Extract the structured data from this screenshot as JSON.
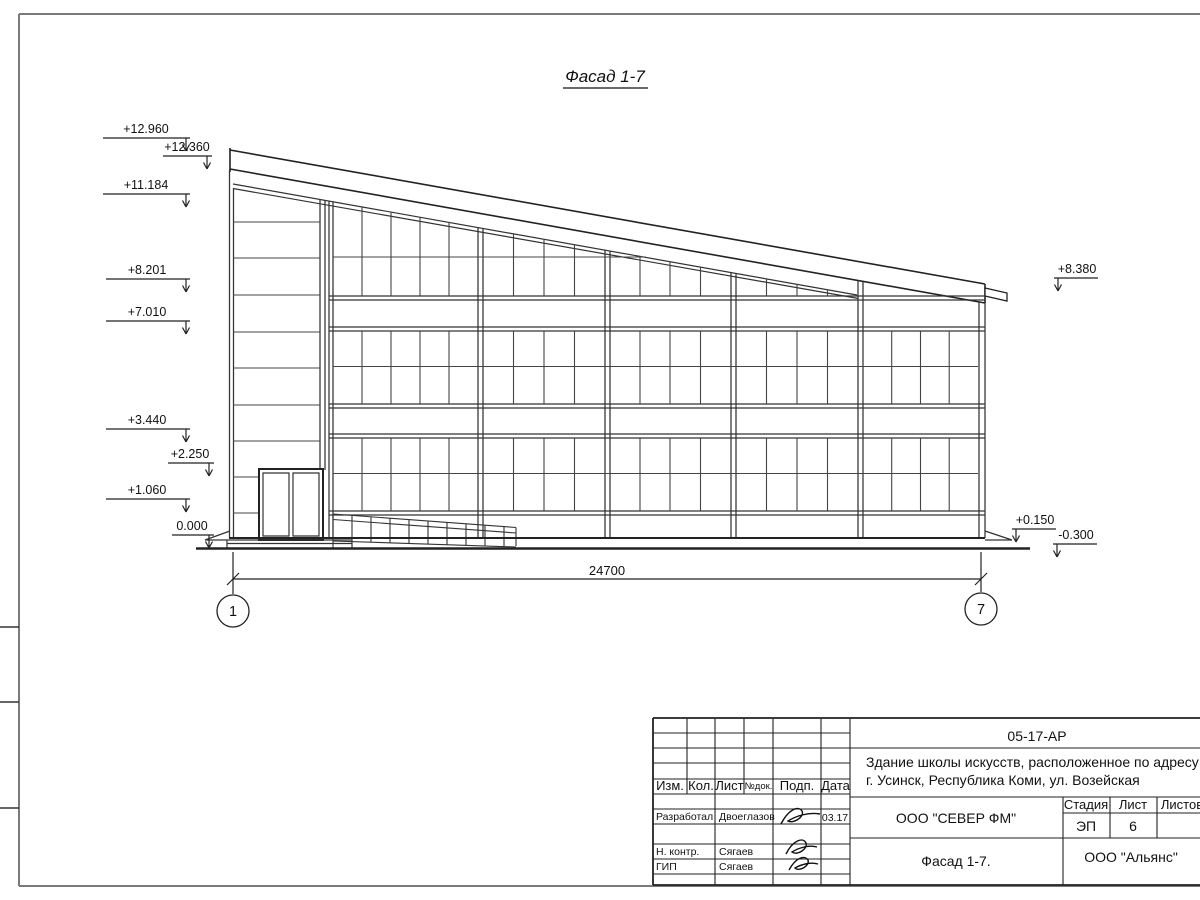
{
  "sheet": {
    "title": "Фасад 1-7",
    "dimension_total": "24700",
    "grid_axis_left": "1",
    "grid_axis_right": "7",
    "elevations_left": [
      {
        "value": "+12.960"
      },
      {
        "value": "+12.360"
      },
      {
        "value": "+11.184"
      },
      {
        "value": "+8.201"
      },
      {
        "value": "+7.010"
      },
      {
        "value": "+3.440"
      },
      {
        "value": "+2.250"
      },
      {
        "value": "+1.060"
      },
      {
        "value": "0.000"
      }
    ],
    "elevations_right": [
      {
        "value": "+8.380"
      },
      {
        "value": "+0.150"
      },
      {
        "value": "-0.300"
      }
    ]
  },
  "title_block": {
    "doc_number": "05-17-АР",
    "project_line1": "Здание школы искусств, расположенное по адресу:",
    "project_line2": "г. Усинск, Республика Коми, ул. Возейская",
    "company": "ООО \"СЕВЕР ФМ\"",
    "drawing_name": "Фасад 1-7.",
    "client": "ООО \"Альянс\"",
    "stage_label": "Стадия",
    "stage_value": "ЭП",
    "sheet_label": "Лист",
    "sheet_value": "6",
    "sheets_label": "Листов",
    "col_izm": "Изм.",
    "col_kol": "Кол.",
    "col_list": "Лист",
    "col_dok": "№док.",
    "col_podp": "Подп.",
    "col_data": "Дата",
    "row1_role": "Разработал",
    "row1_name": "Двоеглазов",
    "row1_date": "03.17",
    "row2_role": "Н. контр.",
    "row2_name": "Сягаев",
    "row3_role": "ГИП",
    "row3_name": "Сягаев"
  }
}
